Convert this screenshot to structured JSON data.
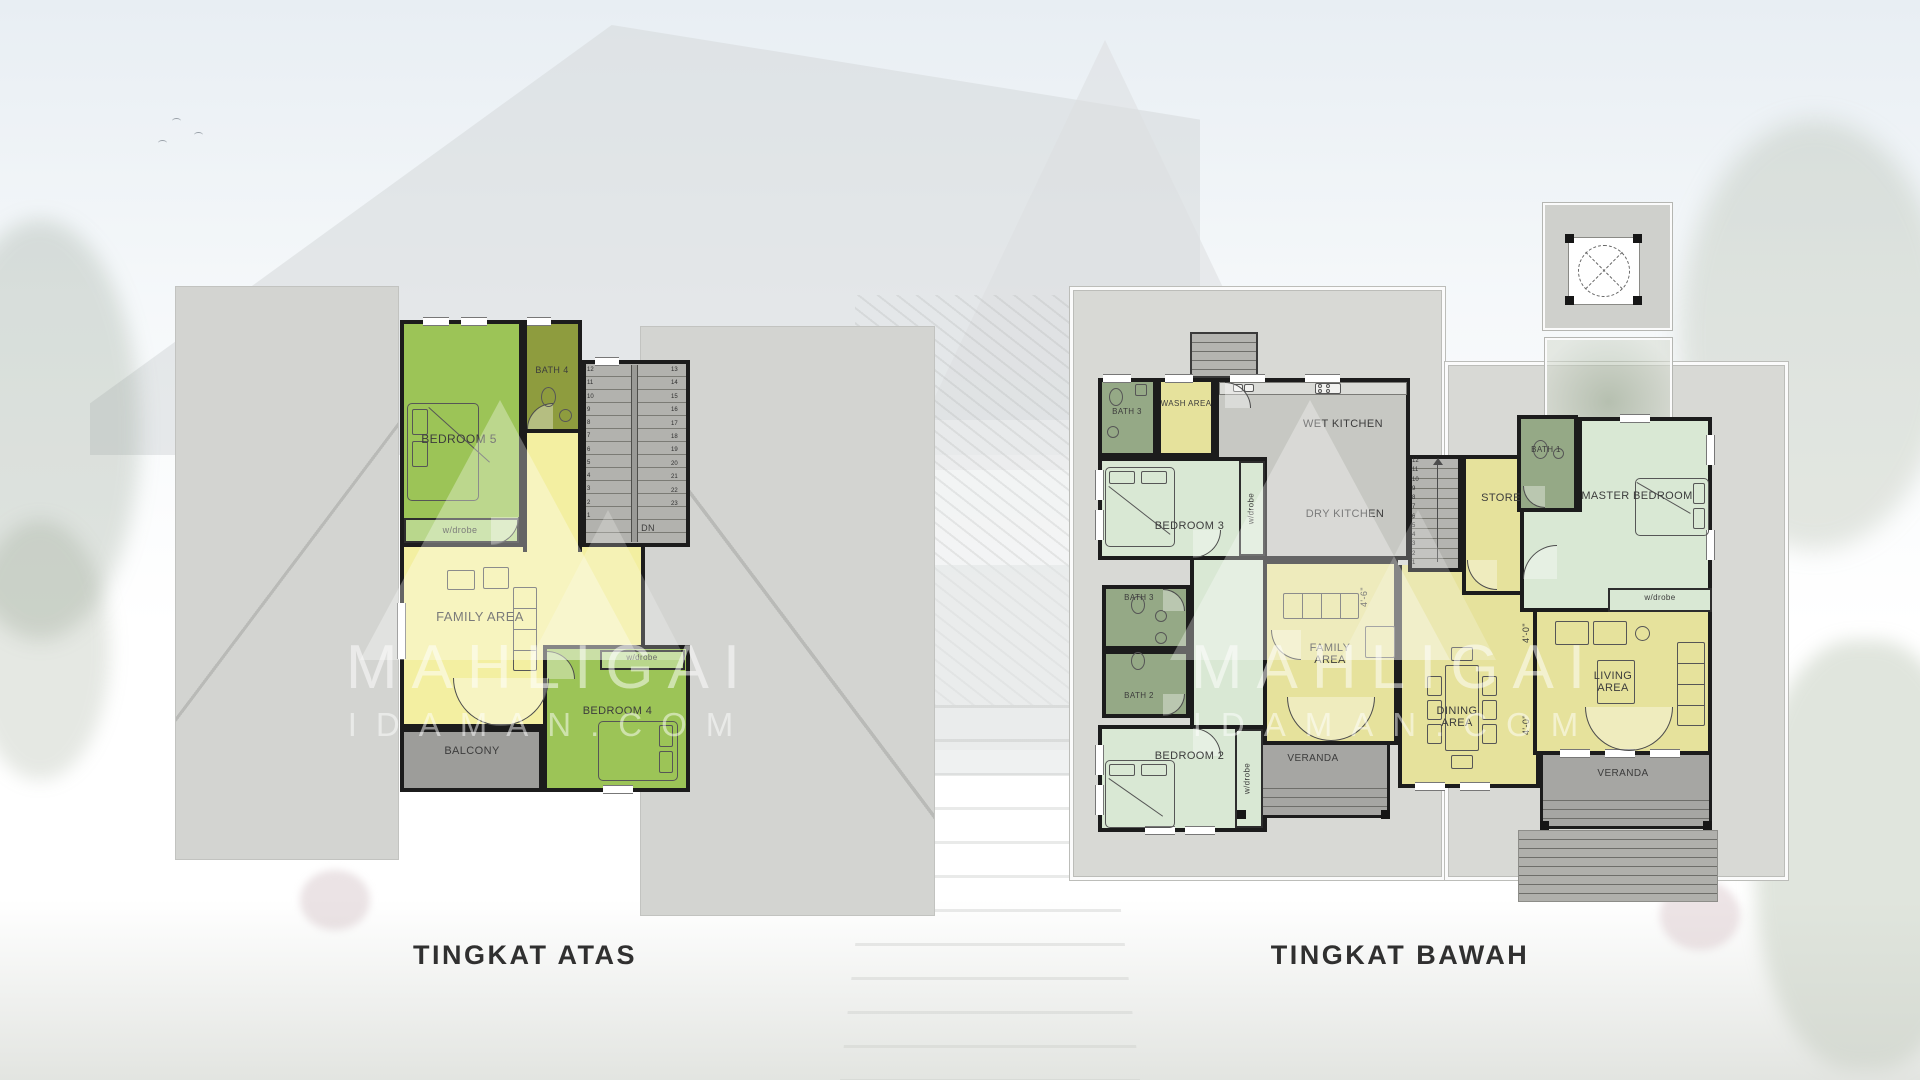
{
  "titles": {
    "upper": "TINGKAT ATAS",
    "lower": "TINGKAT BAWAH"
  },
  "watermark": {
    "line1": "MAHLIGAI",
    "line2": "IDAMAN.COM"
  },
  "colors": {
    "wall": "#1c1c1c",
    "bedroomGreen": "#9cc457",
    "wardrobeGreen": "#b9d78c",
    "bathOlive": "#8e9c3e",
    "yellowUpper": "#f3efa1",
    "yellowLower": "#e6e29c",
    "mint": "#d9e8d4",
    "sage": "#95a986",
    "kitchenGray": "#c7c8c3",
    "stairsGray": "#b2b2ae",
    "balconyGray": "#9d9d9a",
    "verandaGray": "#a6a6a3",
    "roofGray": "#d3d4d1",
    "apronGray": "#d8d9d5",
    "labelColor": "#3c3c3c"
  },
  "upper_floor": {
    "rooms": {
      "bedroom5": "BEDROOM 5",
      "wardrobe5": "w/drobe",
      "bath4": "BATH 4",
      "family": "FAMILY AREA",
      "bedroom4": "BEDROOM 4",
      "wardrobe4": "w/drobe",
      "balcony": "BALCONY"
    },
    "dn": "DN",
    "stairs_left": [
      "12",
      "11",
      "10",
      "9",
      "8",
      "7",
      "6",
      "5",
      "4",
      "3",
      "2",
      "1"
    ],
    "stairs_right": [
      "13",
      "14",
      "15",
      "16",
      "17",
      "18",
      "19",
      "20",
      "21",
      "22",
      "23"
    ]
  },
  "lower_floor": {
    "rooms": {
      "bath3_top": "BATH 3",
      "wash": "WASH AREA",
      "wet_kitchen": "WET KITCHEN",
      "dry_kitchen": "DRY KITCHEN",
      "bedroom3": "BEDROOM 3",
      "wardrobe3": "w/drobe",
      "store": "STORE",
      "bath1": "BATH 1",
      "master": "MASTER BEDROOM",
      "wardrobe_master": "w/drobe",
      "bath3_mid": "BATH 3",
      "bath2": "BATH 2",
      "family": "FAMILY AREA",
      "dining": "DINING AREA",
      "living": "LIVING AREA",
      "bedroom2": "BEDROOM 2",
      "wardrobe2": "w/drobe",
      "veranda_left": "VERANDA",
      "veranda_right": "VERANDA"
    },
    "stairs": [
      "12",
      "11",
      "10",
      "9",
      "8",
      "7",
      "6",
      "5",
      "4",
      "3",
      "2",
      "1"
    ],
    "dims": {
      "d1": "4'-6\"",
      "d2": "4'-0\"",
      "d3": "4'-0\""
    }
  }
}
